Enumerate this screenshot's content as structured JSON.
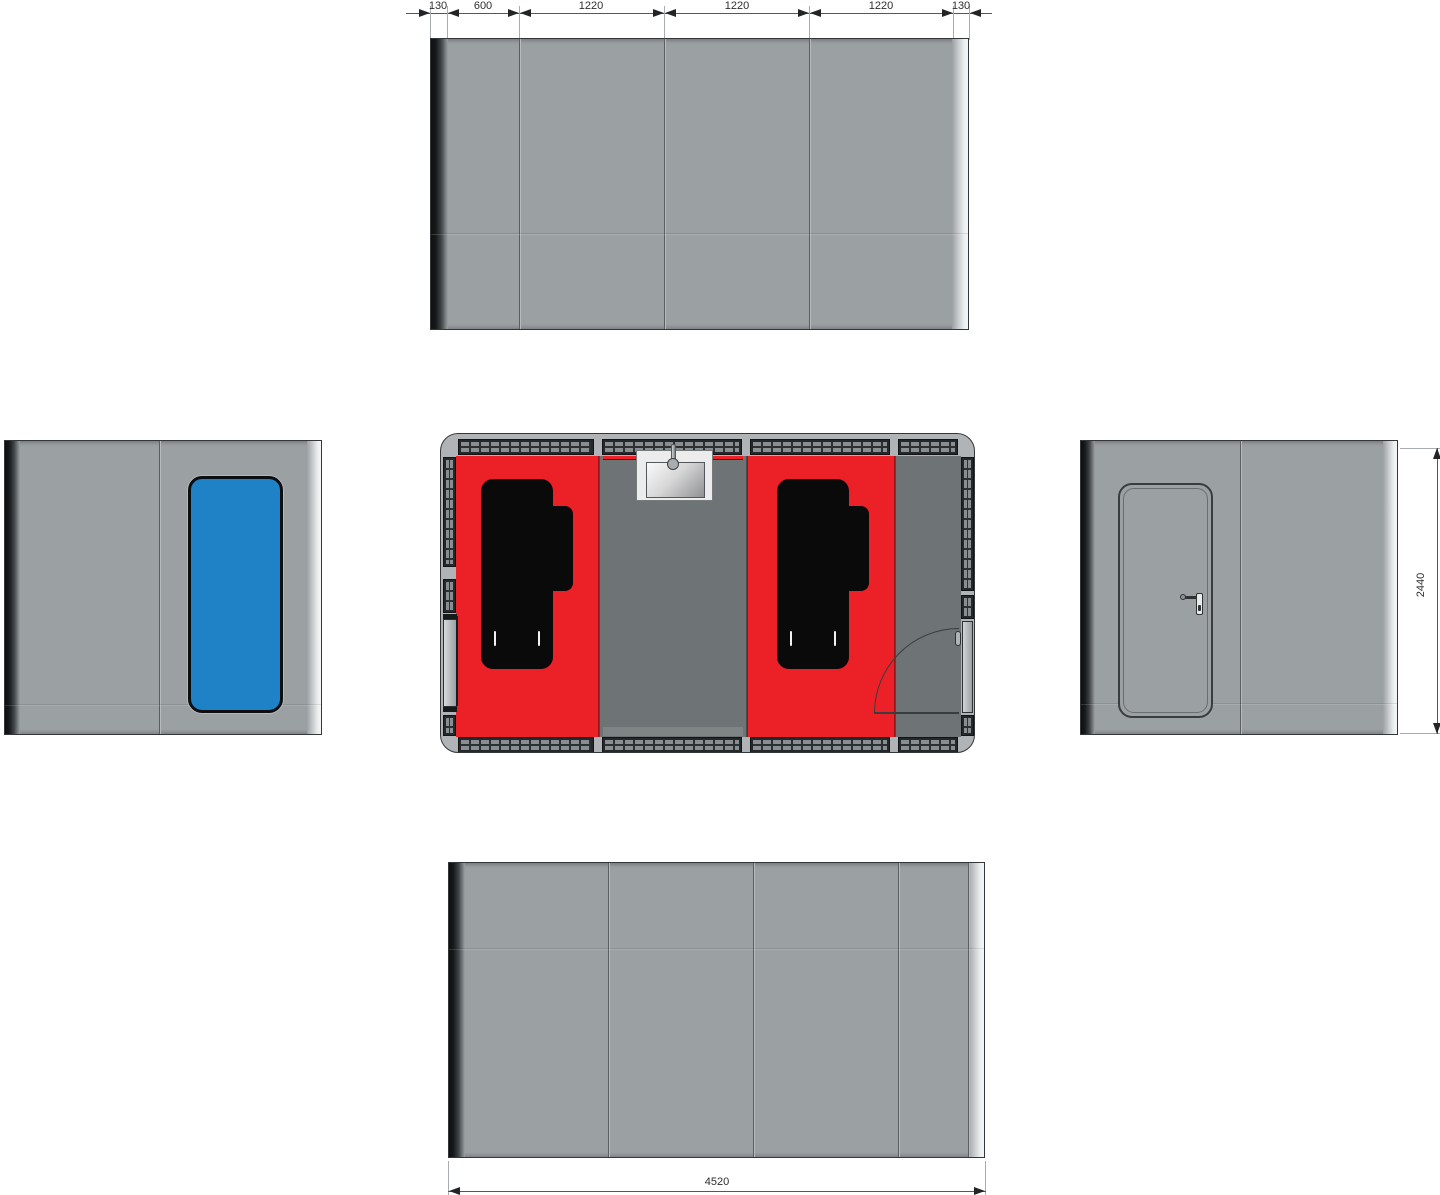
{
  "dims": {
    "top": [
      "130",
      "600",
      "1220",
      "1220",
      "1220",
      "130"
    ],
    "height": "2440",
    "width": "4520"
  },
  "colors": {
    "body_gray": "#9ba0a2",
    "floor_red": "#ec2127",
    "floor_gray": "#6e7375",
    "wall_dark": "#24282a",
    "wall_cell": "#898e90",
    "frame_light": "#b0b4b6",
    "window_blue": "#1f81c6",
    "fixture_black": "#0a0a0a",
    "sink_light": "#ececec",
    "line_dark": "#33373a",
    "seam_dark": "#5a5e60",
    "seam_light": "#b7bbbd",
    "dim_line": "#55585a",
    "dim_ext": "#a9adaf",
    "dim_text": "#2e2e2e",
    "arrow": "#222426",
    "edge_dark": "#111315",
    "edge_light": "#f4f6f6"
  }
}
